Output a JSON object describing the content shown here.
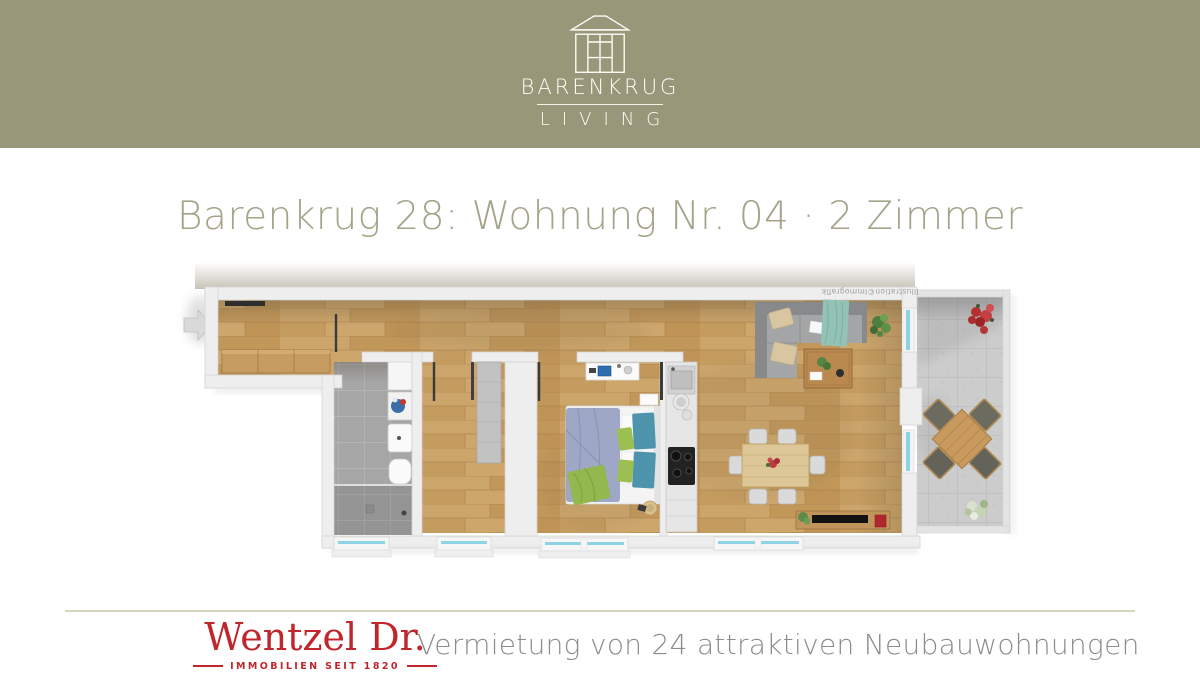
{
  "header": {
    "brand": "BARENKRUG",
    "brand_sub": "LIVING"
  },
  "title": "Barenkrug 28: Wohnung Nr. 04 · 2 Zimmer",
  "floorplan": {
    "watermark": "Illustration©Immografik",
    "rooms": [
      "Flur",
      "Bad",
      "Abstellraum",
      "Schlafzimmer",
      "Küche",
      "Wohnen/Essen",
      "Terrasse"
    ]
  },
  "footer": {
    "brand": "Wentzel Dr.",
    "brand_sub": "IMMOBILIEN SEIT 1820",
    "tagline": "Vermietung von 24 attraktiven Neubauwohnungen"
  },
  "colors": {
    "banner_olive": "#98977a",
    "title_olive": "#a5a389",
    "brand_red": "#c0262c",
    "tagline_gray": "#8c8c8c",
    "divider_tan": "#d7d4bf",
    "wood_floor": "#c89f64",
    "bath_tile": "#a6a6a6",
    "terrace_tile": "#cccccc",
    "window_glass": "#8fd2e4"
  }
}
